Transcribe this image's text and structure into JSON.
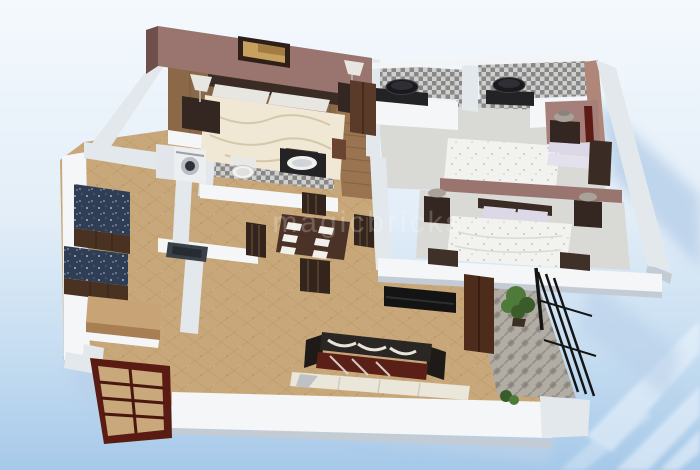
{
  "watermark": {
    "text": "magicbricks"
  },
  "colors": {
    "bg_top": "#f4f9fd",
    "bg_mid": "#e3eef8",
    "bg_low": "#c6ddf1",
    "bg_bottom": "#a6c9e9",
    "shadow": "#b9d0e9",
    "streak": "#f0f6fd",
    "wall_top": "#f4f6f8",
    "wall_face": "#e3e8ed",
    "wall_shade": "#c3cbd4",
    "mauve": "#9a7570",
    "mauve_dark": "#6e4f4c",
    "rose_edge": "#b08678",
    "wood_floor": "#8a6848",
    "grey_floor": "#d9d9d5",
    "tan": "#c8a87a",
    "balcony_tile": "#b2ada4",
    "granite": "#2f3d55",
    "cabinet": "#4a3222",
    "door": "#5a1c12",
    "door_pane": "#c9a87c",
    "bed_cream": "#f0e8d4",
    "bed_white": "#f2f2ee",
    "pillow": "#dcd8e8",
    "headboard": "#3a2c24",
    "nightstand": "#342620",
    "lamp_white": "#e8e6e0",
    "lamp_grey": "#a8a29a",
    "sofa_dark": "#2a2624",
    "sofa_maroon": "#5a2018",
    "sofa_seat": "#eae6da",
    "table_wood": "#4a3227",
    "chair_wood": "#33241c",
    "tv": "#141414",
    "wardrobe": "#4e2c1c",
    "plant": "#4e7a3a",
    "plant_dark": "#3a5c2a",
    "railing": "#151515",
    "basin": "#1a1a1e",
    "counter_dark": "#232326",
    "appliance": "#eceef0",
    "watermark": "#ffffff"
  }
}
